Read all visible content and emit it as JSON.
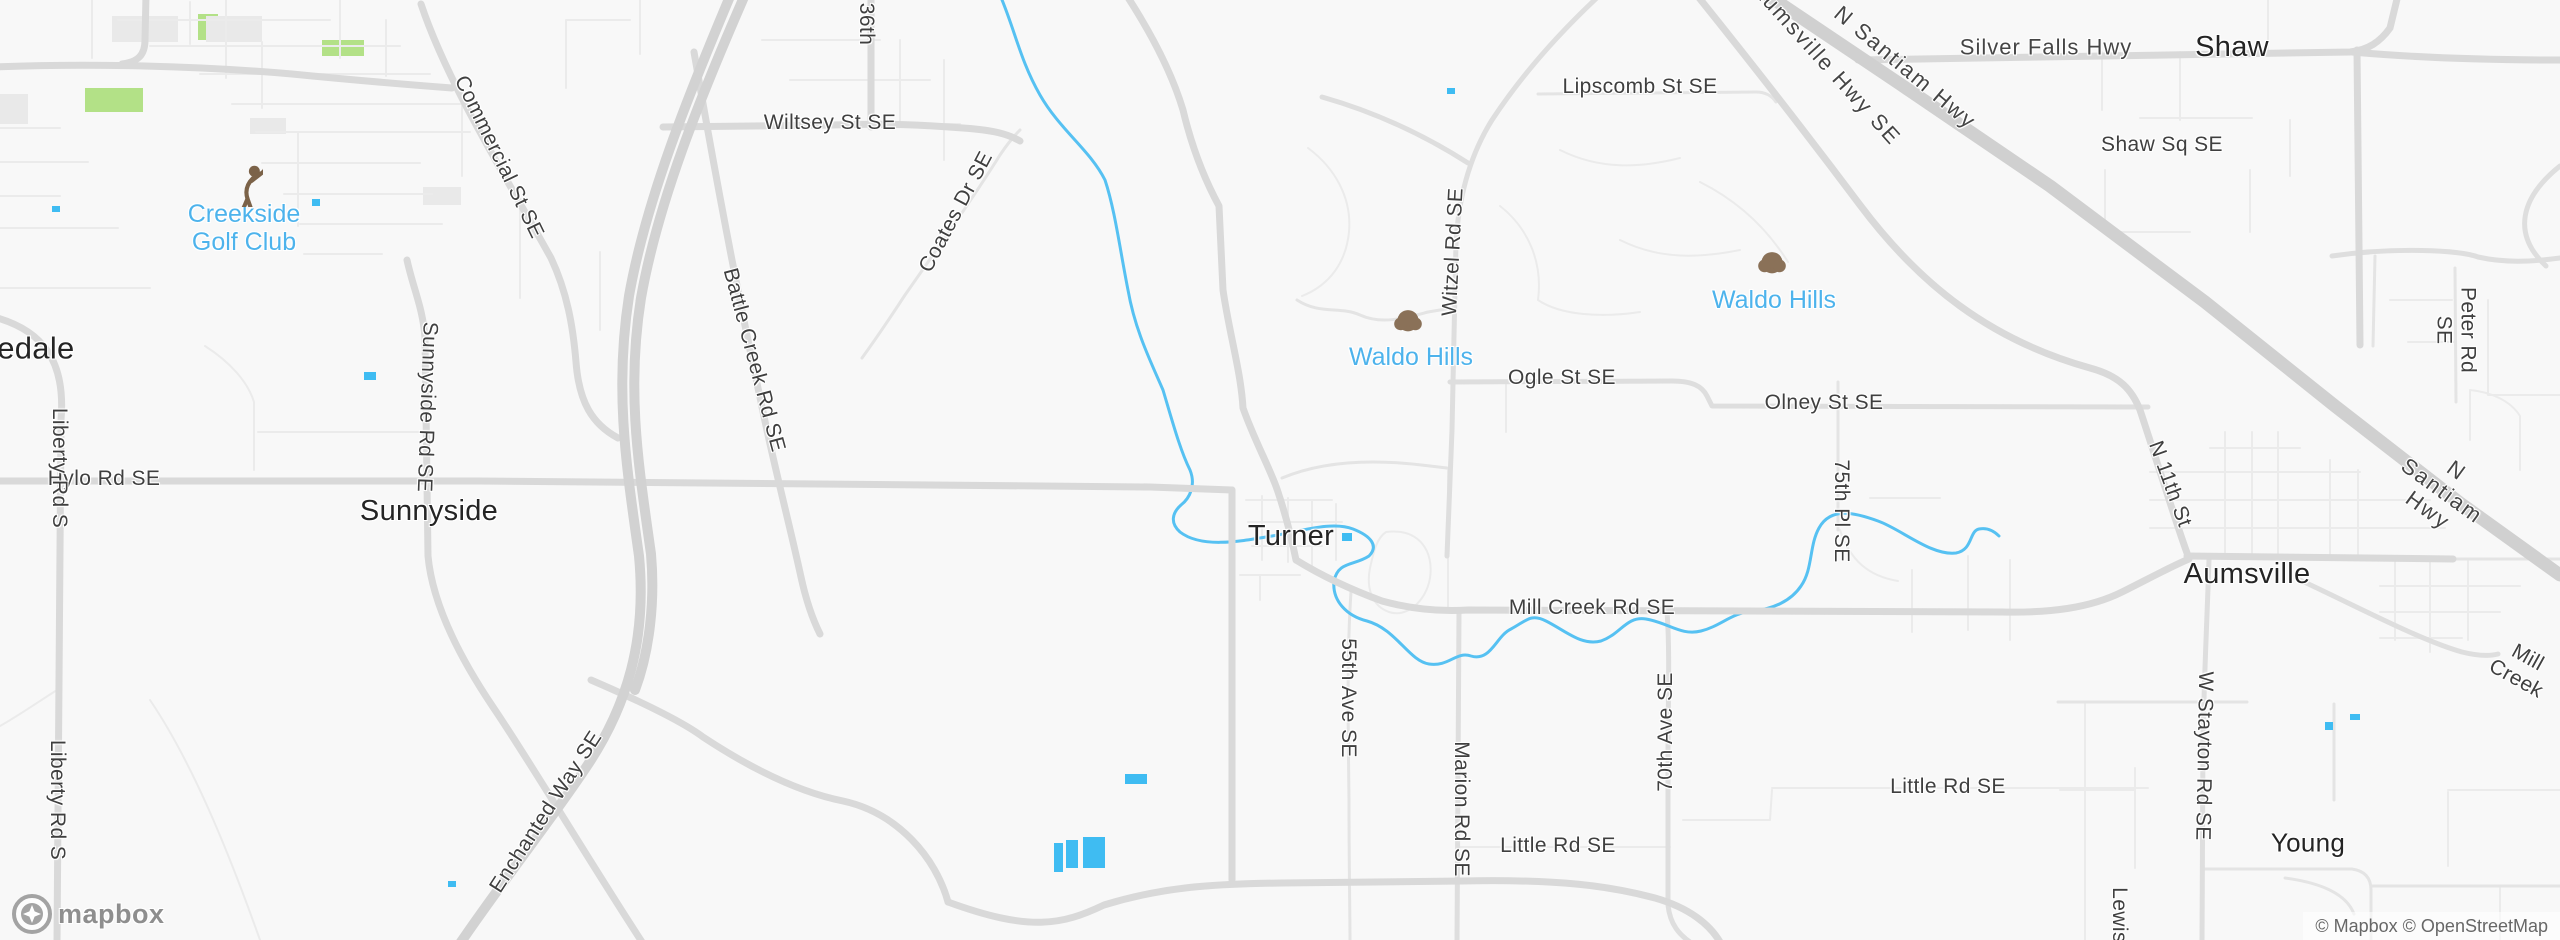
{
  "map": {
    "attribution": "© Mapbox © OpenStreetMap",
    "logo_text": "mapbox",
    "colors": {
      "background": "#f8f8f8",
      "water": "#3fbcf2",
      "river": "#56c1f2",
      "park": "#b3e187",
      "building": "#e9e9e9",
      "road_major": "#d9d9d9",
      "road_minor": "#ebebeb",
      "highway": "#d0d0d0",
      "town_label": "#242424",
      "road_label": "#3f3f3f",
      "poi_label": "#4db3ec",
      "tree_icon": "#8a7158",
      "golfer_icon": "#7b6248"
    },
    "labels": [
      {
        "text": "sedale",
        "x": 28,
        "y": 349,
        "rot": 0,
        "cls": "town lg",
        "name": "town-label-rosedale"
      },
      {
        "text": "Creekside\nGolf Club",
        "x": 244,
        "y": 228,
        "rot": 0,
        "cls": "poi",
        "name": "poi-label-creekside-golf-club"
      },
      {
        "icon": "golfer",
        "x": 242,
        "y": 185,
        "w": 42,
        "h": 44,
        "cls": "icon",
        "name": "golfer-icon"
      },
      {
        "text": "Hylo Rd SE",
        "x": 104,
        "y": 479,
        "rot": 0,
        "cls": "road",
        "name": "road-label-hylo-rd-se"
      },
      {
        "text": "Liberty Rd S",
        "x": 59,
        "y": 468,
        "rot": 90,
        "cls": "road",
        "name": "road-label-liberty-rd-s"
      },
      {
        "text": "Liberty Rd S",
        "x": 57,
        "y": 800,
        "rot": 90,
        "cls": "road",
        "name": "road-label-liberty-rd-s-2"
      },
      {
        "text": "Sunnyside",
        "x": 429,
        "y": 511,
        "rot": 0,
        "cls": "town",
        "name": "town-label-sunnyside"
      },
      {
        "text": "Sunnyside Rd SE",
        "x": 427,
        "y": 407,
        "rot": 92,
        "cls": "road",
        "name": "road-label-sunnyside-rd-se"
      },
      {
        "text": "Commercial St SE",
        "x": 499,
        "y": 157,
        "rot": 64,
        "cls": "road",
        "name": "road-label-commercial-st-se"
      },
      {
        "text": "Battle Creek Rd SE",
        "x": 754,
        "y": 360,
        "rot": 75,
        "cls": "road",
        "name": "road-label-battle-creek-rd-se"
      },
      {
        "text": "36th",
        "x": 866,
        "y": 24,
        "rot": 90,
        "cls": "road",
        "name": "road-label-36th"
      },
      {
        "text": "Wiltsey St SE",
        "x": 830,
        "y": 123,
        "rot": 0,
        "cls": "road",
        "name": "road-label-wiltsey-st-se"
      },
      {
        "text": "Coates Dr SE",
        "x": 956,
        "y": 212,
        "rot": -62,
        "cls": "road",
        "name": "road-label-coates-dr-se"
      },
      {
        "text": "Enchanted Way SE",
        "x": 546,
        "y": 812,
        "rot": -57,
        "cls": "road",
        "name": "road-label-enchanted-way-se"
      },
      {
        "text": "Turner",
        "x": 1291,
        "y": 536,
        "rot": 0,
        "cls": "town",
        "name": "town-label-turner"
      },
      {
        "text": "55th Ave SE",
        "x": 1348,
        "y": 698,
        "rot": 90,
        "cls": "road",
        "name": "road-label-55th-ave-se"
      },
      {
        "text": "Waldo Hills",
        "x": 1411,
        "y": 357,
        "rot": 0,
        "cls": "poi",
        "name": "poi-label-waldo-hills-west"
      },
      {
        "icon": "tree",
        "x": 1408,
        "y": 326,
        "w": 32,
        "h": 34,
        "cls": "icon",
        "name": "tree-icon"
      },
      {
        "text": "Waldo Hills",
        "x": 1774,
        "y": 300,
        "rot": 0,
        "cls": "poi",
        "name": "poi-label-waldo-hills-east"
      },
      {
        "icon": "tree",
        "x": 1772,
        "y": 268,
        "w": 32,
        "h": 34,
        "cls": "icon",
        "name": "tree-icon-2"
      },
      {
        "text": "Witzel Rd SE",
        "x": 1453,
        "y": 252,
        "rot": -87,
        "cls": "road",
        "name": "road-label-witzel-rd-se"
      },
      {
        "text": "Lipscomb St SE",
        "x": 1640,
        "y": 87,
        "rot": 0,
        "cls": "road",
        "name": "road-label-lipscomb-st-se"
      },
      {
        "text": "Ogle St SE",
        "x": 1562,
        "y": 378,
        "rot": 0,
        "cls": "road",
        "name": "road-label-ogle-st-se"
      },
      {
        "text": "Olney St SE",
        "x": 1824,
        "y": 403,
        "rot": 0,
        "cls": "road",
        "name": "road-label-olney-st-se"
      },
      {
        "text": "Mill Creek Rd SE",
        "x": 1592,
        "y": 608,
        "rot": 0,
        "cls": "road",
        "name": "road-label-mill-creek-rd-se"
      },
      {
        "text": "Marion Rd SE",
        "x": 1461,
        "y": 809,
        "rot": 90,
        "cls": "road",
        "name": "road-label-marion-rd-se"
      },
      {
        "text": "70th Ave SE",
        "x": 1666,
        "y": 732,
        "rot": -90,
        "cls": "road",
        "name": "road-label-70th-ave-se"
      },
      {
        "text": "75th Pl SE",
        "x": 1841,
        "y": 511,
        "rot": 90,
        "cls": "road",
        "name": "road-label-75th-pl-se"
      },
      {
        "text": "Little Rd SE",
        "x": 1558,
        "y": 846,
        "rot": 0,
        "cls": "road",
        "name": "road-label-little-rd-se-west"
      },
      {
        "text": "Little Rd SE",
        "x": 1948,
        "y": 787,
        "rot": 0,
        "cls": "road",
        "name": "road-label-little-rd-se-east"
      },
      {
        "text": "Aumsville Hwy SE",
        "x": 1826,
        "y": 64,
        "rot": 48,
        "cls": "road hwy",
        "ls": 2,
        "name": "road-label-aumsville-hwy-se"
      },
      {
        "text": "N Santiam Hwy",
        "x": 1905,
        "y": 68,
        "rot": 40,
        "cls": "road hwy",
        "ls": 2,
        "name": "road-label-n-santiam-hwy-north"
      },
      {
        "text": "Silver Falls Hwy",
        "x": 2046,
        "y": 48,
        "rot": 0,
        "cls": "road hwy",
        "ls": 1,
        "name": "road-label-silver-falls-hwy"
      },
      {
        "text": "Shaw",
        "x": 2232,
        "y": 47,
        "rot": 0,
        "cls": "town",
        "name": "town-label-shaw"
      },
      {
        "text": "Shaw Sq SE",
        "x": 2162,
        "y": 145,
        "rot": 0,
        "cls": "road",
        "name": "road-label-shaw-sq-se"
      },
      {
        "text": "Peter Rd SE",
        "x": 2456,
        "y": 330,
        "rot": 90,
        "cls": "road",
        "name": "road-label-peter-rd-se"
      },
      {
        "text": "N Santiam Hwy",
        "x": 2442,
        "y": 491,
        "rot": 36,
        "cls": "road hwy",
        "ls": 2,
        "name": "road-label-n-santiam-hwy-south"
      },
      {
        "text": "N 11th St",
        "x": 2170,
        "y": 484,
        "rot": 70,
        "cls": "road",
        "name": "road-label-n-11th-st"
      },
      {
        "text": "Aumsville",
        "x": 2247,
        "y": 574,
        "rot": 0,
        "cls": "town",
        "name": "town-label-aumsville"
      },
      {
        "text": "Mill Creek",
        "x": 2522,
        "y": 668,
        "rot": 29,
        "cls": "road",
        "name": "road-label-mill-creek"
      },
      {
        "text": "W Stayton Rd SE",
        "x": 2204,
        "y": 756,
        "rot": 91,
        "cls": "road",
        "name": "road-label-w-stayton-rd-se"
      },
      {
        "text": "Lewis",
        "x": 2119,
        "y": 915,
        "rot": 90,
        "cls": "road",
        "name": "road-label-lewis"
      },
      {
        "text": "Young",
        "x": 2308,
        "y": 843,
        "rot": 0,
        "cls": "town sm",
        "name": "town-label-young"
      }
    ]
  }
}
